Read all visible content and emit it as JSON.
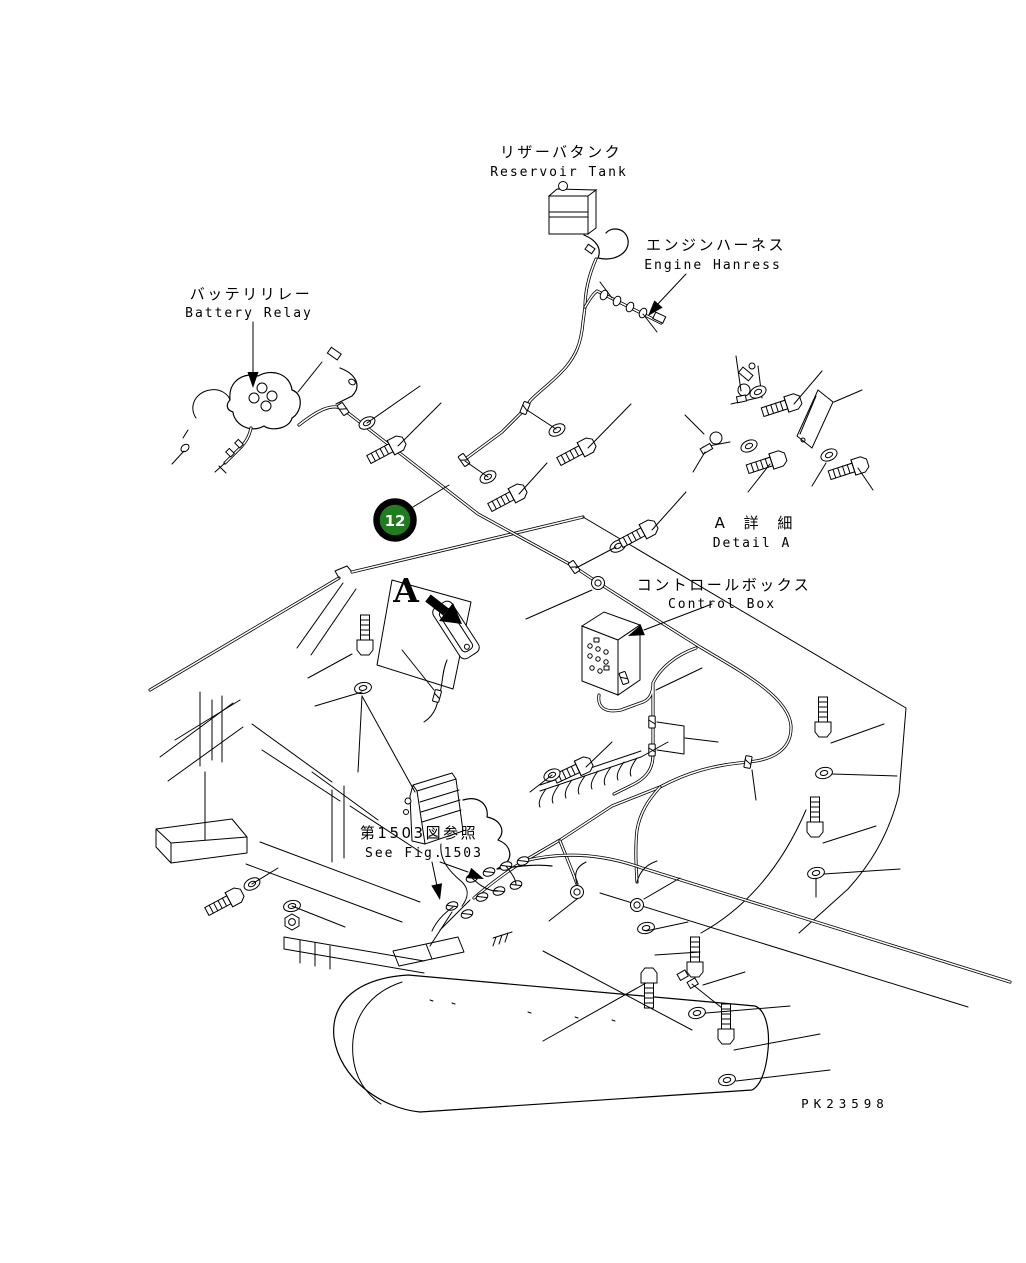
{
  "figure": {
    "labels": {
      "reservoir_tank_jp": "リザーバタンク",
      "reservoir_tank_en": "Reservoir Tank",
      "engine_harness_jp": "エンジンハーネス",
      "engine_harness_en": "Engine Hanress",
      "battery_relay_jp": "バッテリリレー",
      "battery_relay_en": "Battery Relay",
      "detail_a_jp": "A 詳 細",
      "detail_a_en": "Detail A",
      "control_box_jp": "コントロールボックス",
      "control_box_en": "Control Box",
      "see_fig_jp": "第1503図参照",
      "see_fig_en": "See Fig.1503",
      "view_marker": "A"
    },
    "callout": {
      "number": "12",
      "fill_color": "#1f7d1f",
      "ring_color": "#000000",
      "text_color": "#ffffff"
    },
    "part_code": "PK23598",
    "colors": {
      "line": "#000000",
      "background": "#ffffff"
    }
  }
}
